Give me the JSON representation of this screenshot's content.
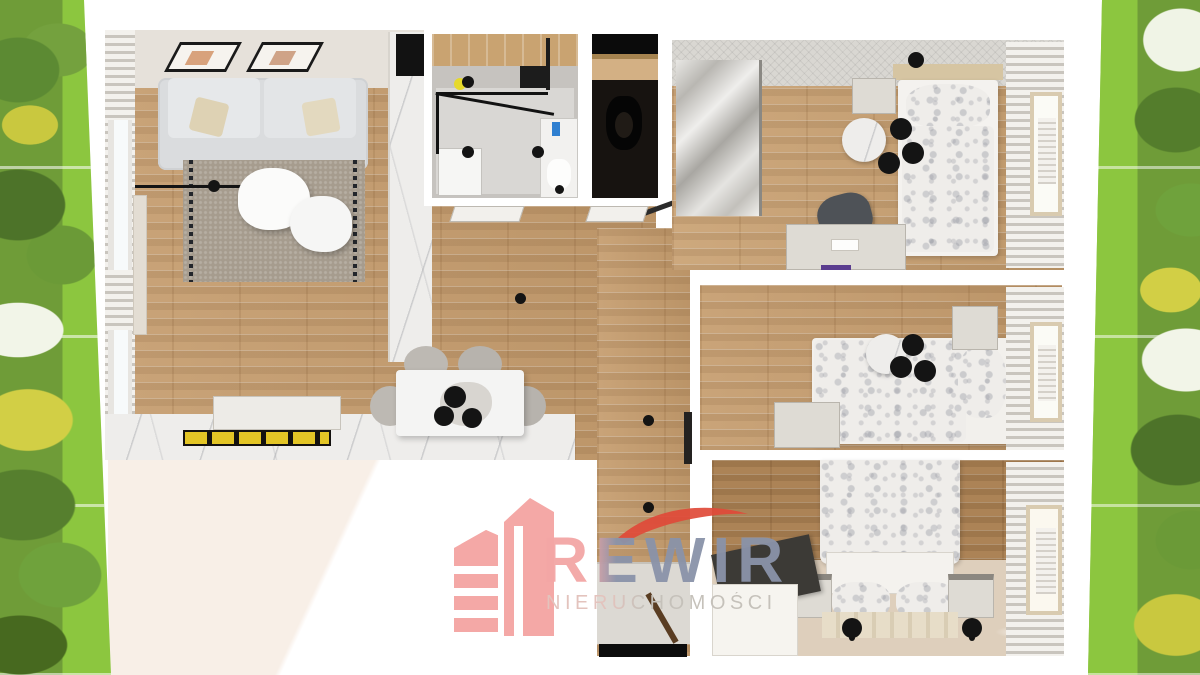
{
  "watermark": {
    "brand": "REWIR",
    "subtitle": "NIERUCHOMOŚCI",
    "brand_color": "#f3a6a5",
    "brand_overlap_color": "#8a93a9",
    "subtitle_color": "#d9bfba",
    "swoosh_color": "#e04a38",
    "icon": "building-towers-icon"
  },
  "scene": {
    "type": "3d-apartment-floor-plan-top-view",
    "rooms": [
      "living-room-with-kitchen",
      "bathroom",
      "wc",
      "hallway",
      "bedroom-1",
      "bedroom-2",
      "bedroom-3"
    ],
    "palette": {
      "wood_floor": "#c59c6d",
      "dark_wood_floor": "#ac8356",
      "marble_floor": "#eeedeb",
      "wall_gap": "#ffffff",
      "accent_rug": "#e3c526"
    }
  },
  "background": {
    "description": "park-trees-and-grass-collage",
    "grass_color": "#8cc63f",
    "foliage_color": "#5d8736",
    "accent_foliage": "#d2cf45",
    "sky_color": "#f2f5e8"
  }
}
